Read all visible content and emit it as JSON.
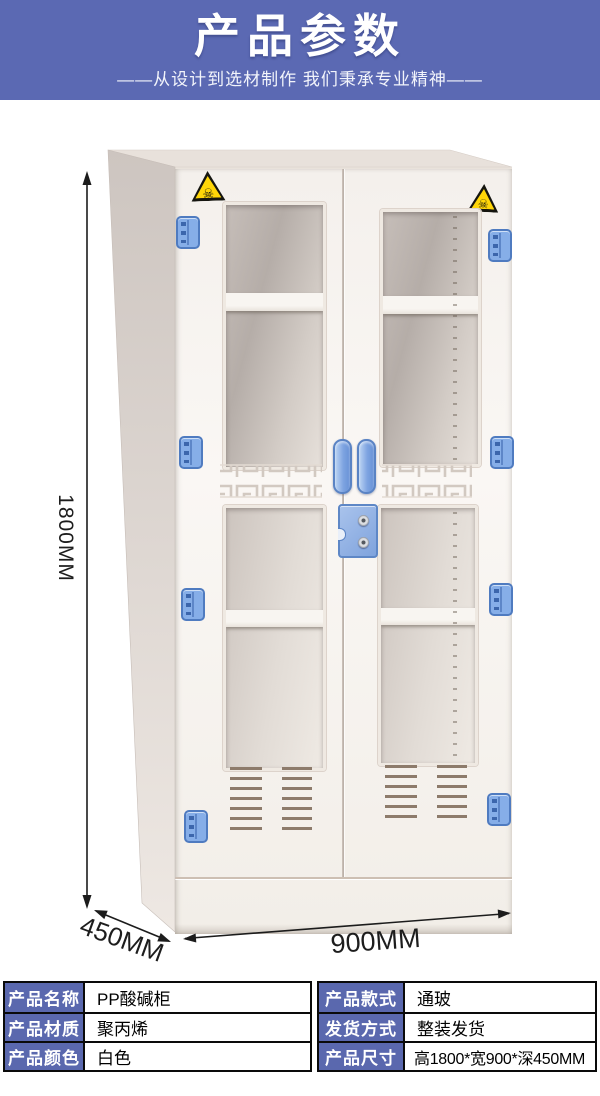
{
  "header": {
    "title": "产品参数",
    "subtitle": "——从设计到选材制作 我们秉承专业精神——"
  },
  "figure": {
    "height_label": "1800MM",
    "depth_label": "450MM",
    "width_label": "900MM",
    "warning_glyph": "☠"
  },
  "spec_table": {
    "rows": [
      {
        "cells": [
          {
            "label": "产品名称",
            "value": "PP酸碱柜"
          },
          {
            "label": "产品款式",
            "value": "通玻"
          }
        ]
      },
      {
        "cells": [
          {
            "label": "产品材质",
            "value": "聚丙烯"
          },
          {
            "label": "发货方式",
            "value": "整装发货"
          }
        ]
      },
      {
        "cells": [
          {
            "label": "产品颜色",
            "value": "白色"
          },
          {
            "label": "产品尺寸",
            "value": "高1800*宽900*深450MM"
          }
        ]
      }
    ]
  },
  "colors": {
    "header_bg": "#5b69b3",
    "table_label_bg": "#5a68ae",
    "hardware_blue": "#86aee8",
    "warning_yellow": "#ffd608",
    "cabinet_body": "#f5f1ed",
    "dimension_line": "#1c1c1c"
  }
}
